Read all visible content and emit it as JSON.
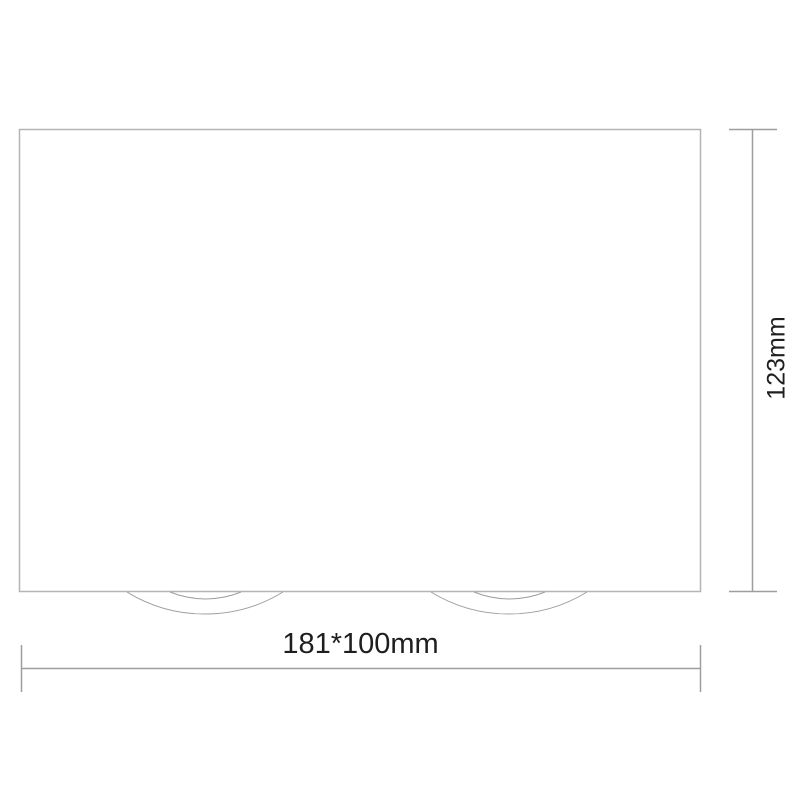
{
  "diagram": {
    "kind": "luminaire-dimension-drawing",
    "width_label": "181*100mm",
    "height_label": "123mm",
    "colors": {
      "background": "#ffffff",
      "fixture_outline": "#b4b4b4",
      "lamp_arcs": "#9e9e9e",
      "dimension_lines": "#9e9e9e",
      "label_text": "#1e1e1e"
    }
  }
}
